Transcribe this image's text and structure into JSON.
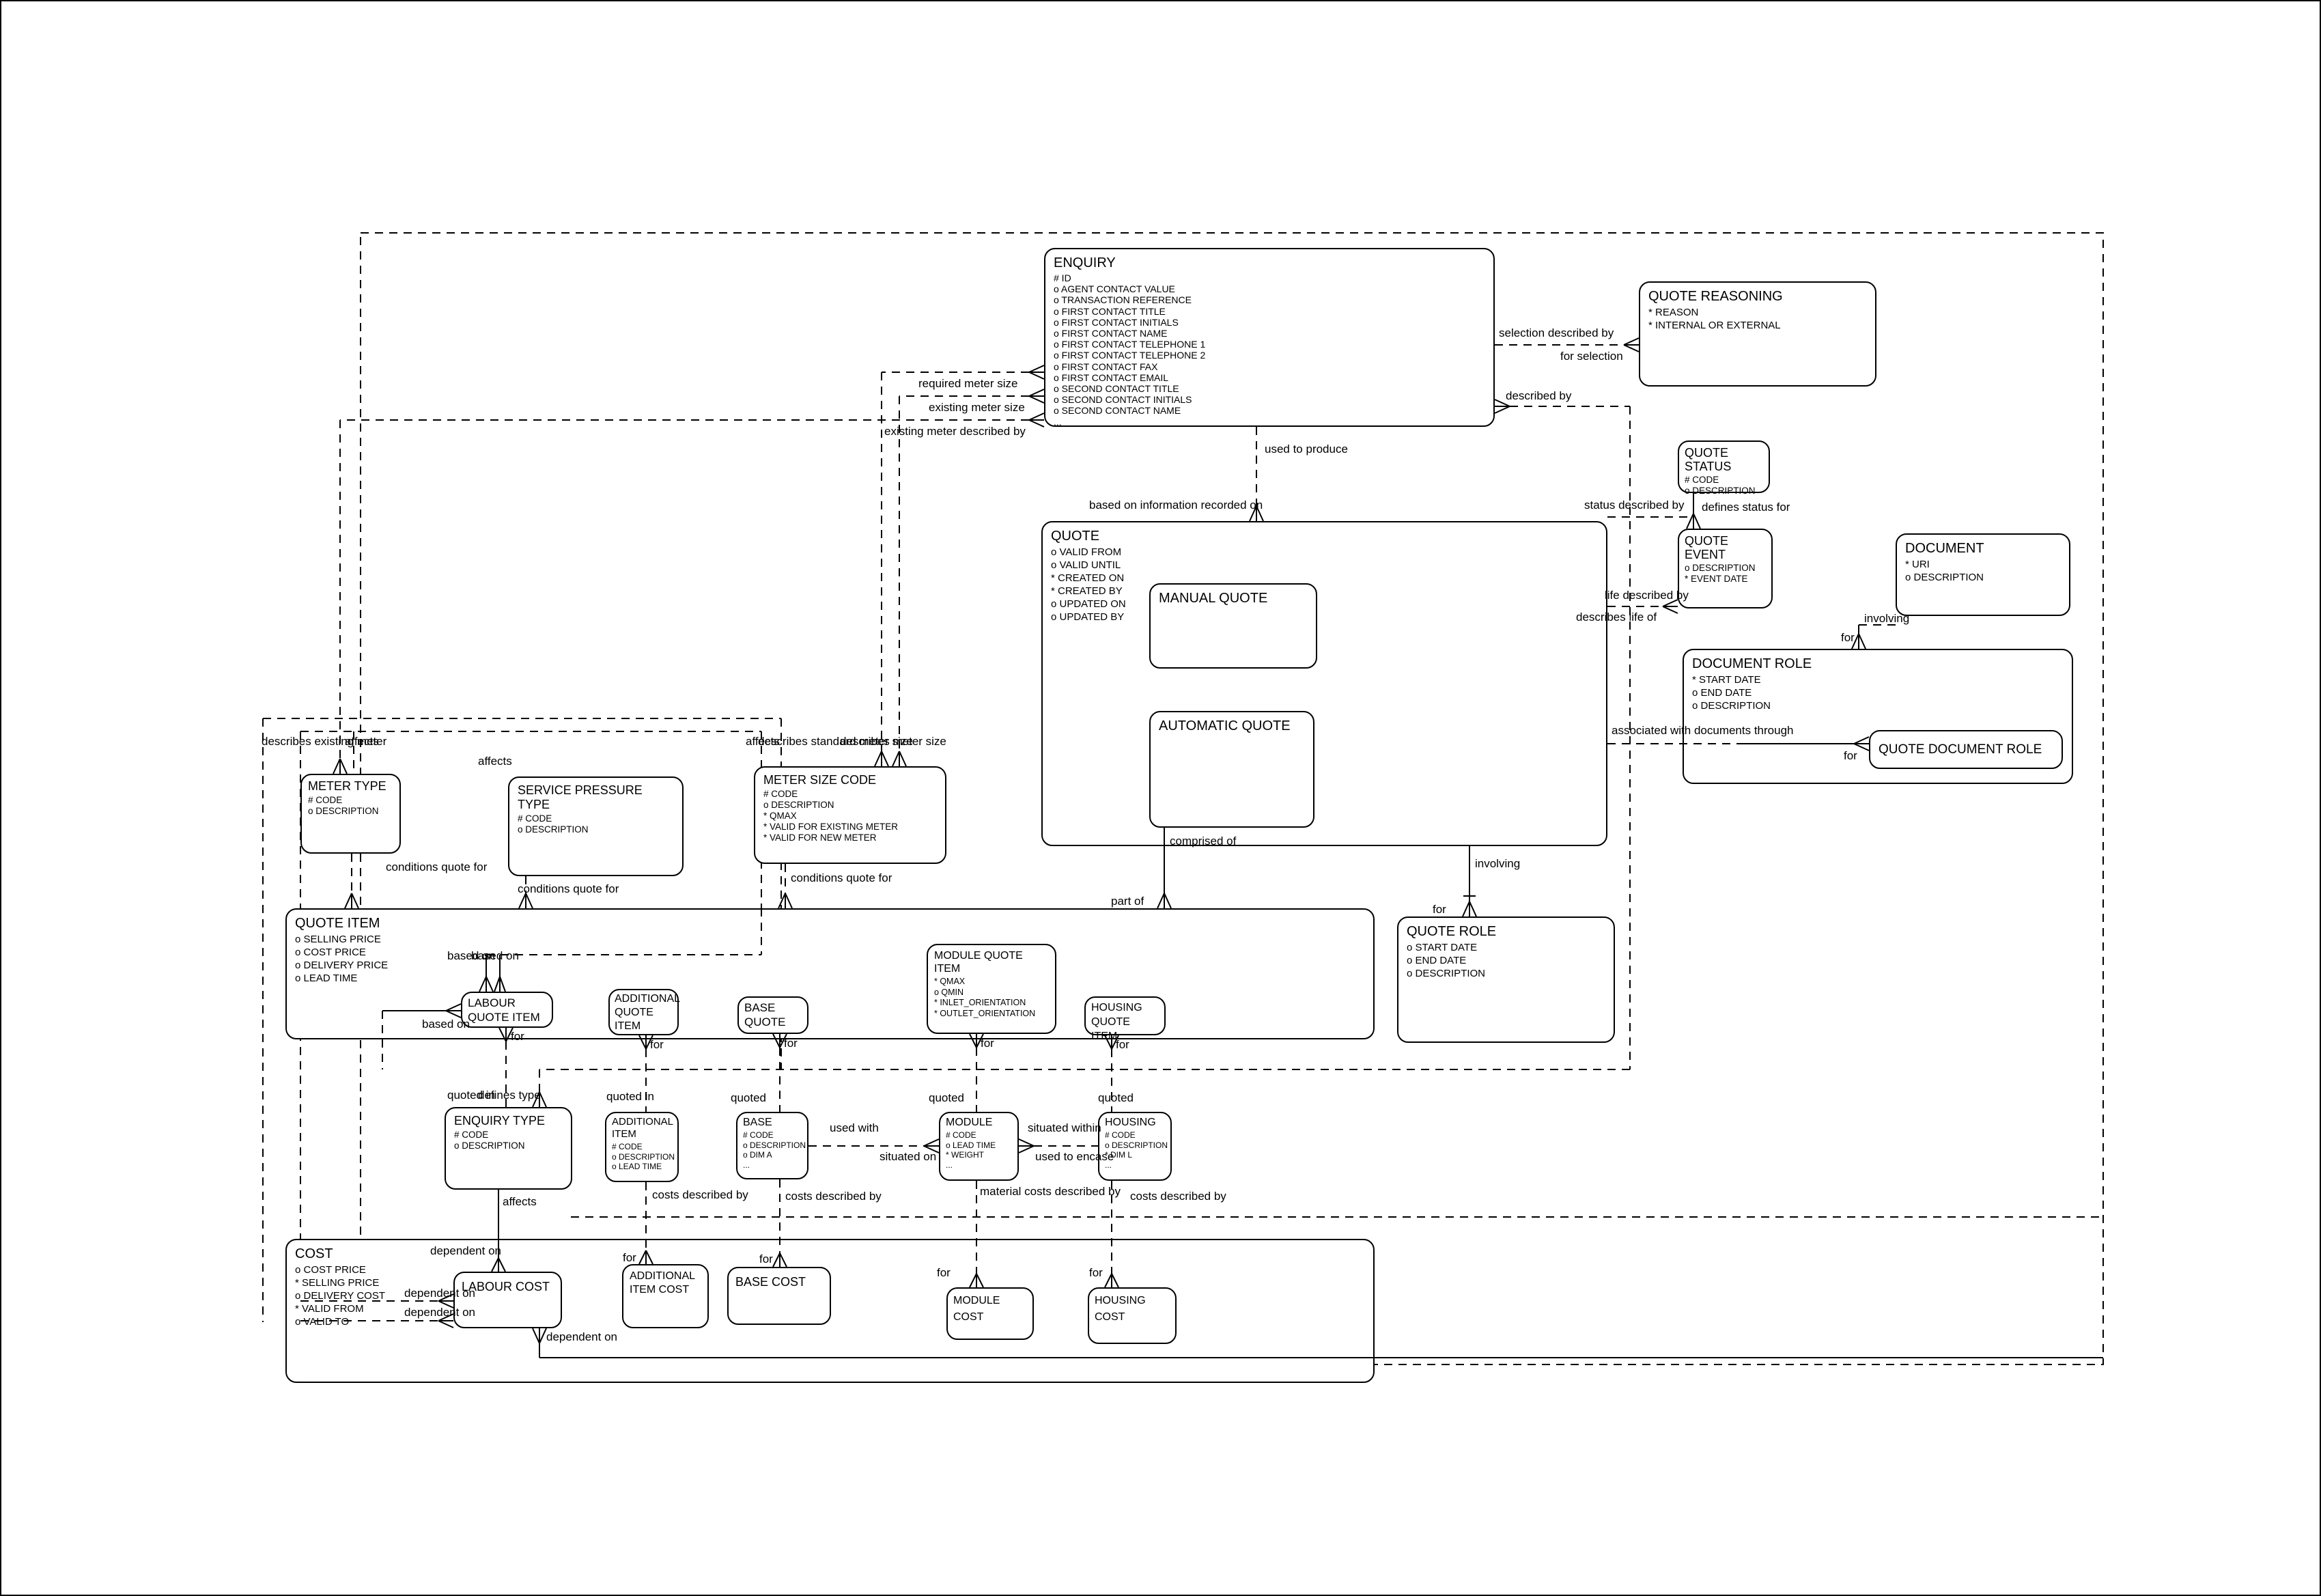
{
  "diagram": {
    "entities": {
      "enquiry": {
        "title": "ENQUIRY",
        "attrs": [
          "# ID",
          "o AGENT CONTACT VALUE",
          "o TRANSACTION REFERENCE",
          "o FIRST CONTACT TITLE",
          "o FIRST CONTACT INITIALS",
          "o FIRST CONTACT NAME",
          "o FIRST CONTACT TELEPHONE 1",
          "o FIRST CONTACT TELEPHONE 2",
          "o FIRST CONTACT FAX",
          "o FIRST CONTACT EMAIL",
          "o SECOND CONTACT TITLE",
          "o SECOND CONTACT INITIALS",
          "o SECOND CONTACT NAME",
          "..."
        ]
      },
      "quote_reasoning": {
        "title": "QUOTE REASONING",
        "attrs": [
          "* REASON",
          "* INTERNAL OR EXTERNAL"
        ]
      },
      "quote_status": {
        "title": "QUOTE STATUS",
        "attrs": [
          "# CODE",
          "o DESCRIPTION"
        ]
      },
      "quote_event": {
        "title": "QUOTE EVENT",
        "attrs": [
          "o DESCRIPTION",
          "* EVENT DATE"
        ]
      },
      "document": {
        "title": "DOCUMENT",
        "attrs": [
          "* URI",
          "o DESCRIPTION"
        ]
      },
      "document_role": {
        "title": "DOCUMENT ROLE",
        "attrs": [
          "* START DATE",
          "o END DATE",
          "o DESCRIPTION"
        ]
      },
      "quote_document_role": {
        "title": "QUOTE DOCUMENT ROLE",
        "attrs": []
      },
      "quote": {
        "title": "QUOTE",
        "attrs": [
          "o VALID FROM",
          "o VALID UNTIL",
          "* CREATED ON",
          "* CREATED BY",
          "o UPDATED ON",
          "o UPDATED BY"
        ]
      },
      "manual_quote": {
        "title": "MANUAL QUOTE",
        "attrs": []
      },
      "automatic_quote": {
        "title": "AUTOMATIC QUOTE",
        "attrs": []
      },
      "quote_role": {
        "title": "QUOTE ROLE",
        "attrs": [
          "o START DATE",
          "o END DATE",
          "o DESCRIPTION"
        ]
      },
      "meter_type": {
        "title": "METER TYPE",
        "attrs": [
          "# CODE",
          "o DESCRIPTION"
        ]
      },
      "service_pressure_type": {
        "title": "SERVICE PRESSURE TYPE",
        "attrs": [
          "# CODE",
          "o DESCRIPTION"
        ]
      },
      "meter_size_code": {
        "title": "METER SIZE CODE",
        "attrs": [
          "# CODE",
          "o DESCRIPTION",
          "* QMAX",
          "* VALID FOR EXISTING METER",
          "* VALID FOR NEW METER"
        ]
      },
      "quote_item": {
        "title": "QUOTE ITEM",
        "attrs": [
          "o SELLING PRICE",
          "o COST PRICE",
          "o DELIVERY PRICE",
          "o LEAD TIME"
        ]
      },
      "labour_quote_item": {
        "title": "LABOUR\nQUOTE ITEM",
        "attrs": []
      },
      "additional_quote_item": {
        "title": "ADDITIONAL\nQUOTE\nITEM",
        "attrs": []
      },
      "base_quote": {
        "title": "BASE\nQUOTE",
        "attrs": []
      },
      "module_quote_item": {
        "title": "MODULE QUOTE ITEM",
        "attrs": [
          "* QMAX",
          "o QMIN",
          "* INLET_ORIENTATION",
          "* OUTLET_ORIENTATION"
        ]
      },
      "housing_quote_item": {
        "title": "HOUSING\nQUOTE ITEM",
        "attrs": []
      },
      "enquiry_type": {
        "title": "ENQUIRY TYPE",
        "attrs": [
          "# CODE",
          "o DESCRIPTION"
        ]
      },
      "additional_item": {
        "title": "ADDITIONAL\nITEM",
        "attrs": [
          "# CODE",
          "o DESCRIPTION",
          "o LEAD TIME"
        ]
      },
      "base": {
        "title": "BASE",
        "attrs": [
          "# CODE",
          "o DESCRIPTION",
          "o DIM A",
          "..."
        ]
      },
      "module": {
        "title": "MODULE",
        "attrs": [
          "# CODE",
          "o LEAD TIME",
          "* WEIGHT",
          "..."
        ]
      },
      "housing": {
        "title": "HOUSING",
        "attrs": [
          "# CODE",
          "o DESCRIPTION",
          "* DIM L",
          "..."
        ]
      },
      "cost": {
        "title": "COST",
        "attrs": [
          "o COST PRICE",
          "* SELLING PRICE",
          "o DELIVERY COST",
          "* VALID FROM",
          "o VALID TO"
        ]
      },
      "labour_cost": {
        "title": "LABOUR COST",
        "attrs": []
      },
      "additional_item_cost": {
        "title": "ADDITIONAL\nITEM COST",
        "attrs": []
      },
      "base_cost": {
        "title": "BASE COST",
        "attrs": []
      },
      "module_cost": {
        "title": "MODULE COST",
        "attrs": []
      },
      "housing_cost": {
        "title": "HOUSING COST",
        "attrs": []
      }
    },
    "rel_labels": [
      "required meter size",
      "existing meter size",
      "existing meter described by",
      "used to produce",
      "based on information recorded on",
      "selection described by",
      "for selection",
      "described by",
      "status described by",
      "defines status for",
      "life described by",
      "describes life of",
      "involving",
      "for",
      "associated with documents through",
      "for",
      "comprised of",
      "part of",
      "involving",
      "for",
      "describes existing meter",
      "affects",
      "affects",
      "affects",
      "describes standard meter size",
      "describes meter size",
      "conditions quote for",
      "conditions quote for",
      "conditions quote for",
      "based on",
      "based on",
      "based on",
      "for",
      "for",
      "for",
      "for",
      "for",
      "quoted in",
      "defines type",
      "quoted in",
      "quoted",
      "quoted",
      "quoted",
      "used with",
      "situated on",
      "situated within",
      "used to encase",
      "affects",
      "costs described by",
      "costs described by",
      "material costs described by",
      "costs described by",
      "dependent on",
      "for",
      "for",
      "for",
      "for",
      "dependent on",
      "dependent on",
      "dependent on"
    ]
  }
}
